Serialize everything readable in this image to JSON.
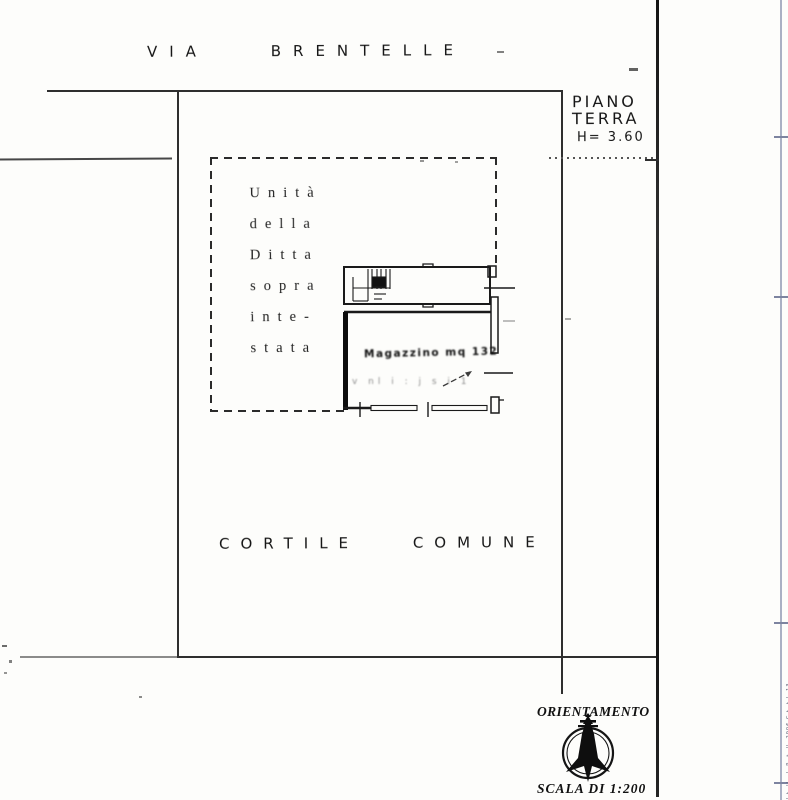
{
  "labels": {
    "street": {
      "word1": "VIA",
      "word2": "BRENTELLE"
    },
    "floor": {
      "line1": "PIANO",
      "line2": "TERRA",
      "height": "H= 3.60"
    },
    "ownership_note_lines": [
      "Unità",
      "della",
      "Ditta",
      "sopra",
      "inte-",
      "stata"
    ],
    "room_note": "Magazzino mq 132",
    "faint_note": "v nl i : j s i 1",
    "courtyard": {
      "word1": "CORTILE",
      "word2": "COMUNE"
    },
    "orientation_title": "ORIENTAMENTO",
    "scale_note": "SCALA DI 1:200",
    "edge_microtext": "l·t··ll· ·l· P··t··ll· 2906 C·t··t·l· 13"
  },
  "colors": {
    "ink": "#222222",
    "faint_ink": "#8d8d8d",
    "scan_edge_line": "#aab0c4",
    "paper": "#fdfdfb"
  }
}
